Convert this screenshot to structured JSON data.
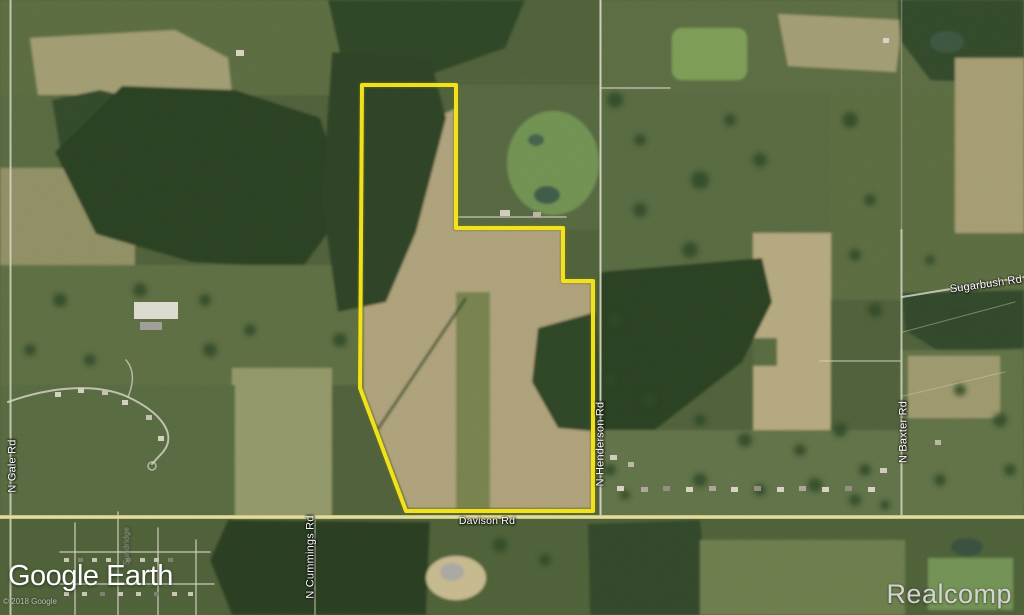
{
  "watermarks": {
    "logo_text": "Google Earth",
    "copyright_text": "© 2018 Google",
    "brand_text": "Realcomp"
  },
  "road_labels": {
    "davison": "Davison Rd",
    "henderson": "N Henderson Rd",
    "baxter": "N Baxter Rd",
    "gale": "N Gale Rd",
    "cummings": "N Cummings Rd",
    "sugarbush": "Sugarbush Rd",
    "subdivision_street": "Sundridge"
  },
  "parcel": {
    "points": "362,85 456,85 456,228 563,228 563,281 593,281 593,511 406,511 360,388",
    "stroke_color": "#f5e51b",
    "stroke_width": "4"
  },
  "roads": {
    "davison_highlight_color": "#cfc783",
    "minor_road_color": "#ddd9c7"
  },
  "terrain_colors": {
    "field_green": "#4e5f3a",
    "field_tan": "#ac9f78",
    "forest_green": "#2c4124"
  }
}
